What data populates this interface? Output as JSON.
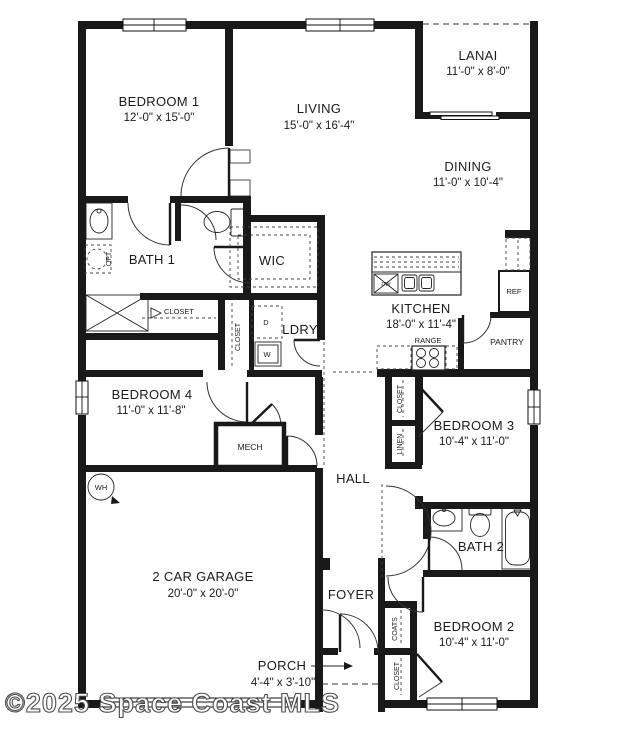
{
  "watermark": "©2025 Space Coast MLS",
  "colors": {
    "wall": "#191919",
    "background": "#ffffff",
    "watermark_outline": "#4b4b4b"
  },
  "rooms": {
    "bedroom1": {
      "name": "BEDROOM 1",
      "dims": "12'-0\" x 15'-0\""
    },
    "living": {
      "name": "LIVING",
      "dims": "15'-0\" x 16'-4\""
    },
    "lanai": {
      "name": "LANAI",
      "dims": "11'-0\" x 8'-0\""
    },
    "dining": {
      "name": "DINING",
      "dims": "11'-0\" x 10'-4\""
    },
    "kitchen": {
      "name": "KITCHEN",
      "dims": "18'-0\" x 11'-4\""
    },
    "bath1": {
      "name": "BATH 1"
    },
    "wic": {
      "name": "WIC"
    },
    "ldry": {
      "name": "LDRY"
    },
    "bedroom4": {
      "name": "BEDROOM 4",
      "dims": "11'-0\" x 11'-8\""
    },
    "bedroom3": {
      "name": "BEDROOM 3",
      "dims": "10'-4\" x 11'-0\""
    },
    "bedroom2": {
      "name": "BEDROOM 2",
      "dims": "10'-4\" x 11'-0\""
    },
    "bath2": {
      "name": "BATH 2"
    },
    "hall": {
      "name": "HALL"
    },
    "foyer": {
      "name": "FOYER"
    },
    "garage": {
      "name": "2 CAR GARAGE",
      "dims": "20'-0\" x 20'-0\""
    },
    "porch": {
      "name": "PORCH",
      "dims": "4'-4\" x 3'-10\""
    },
    "mech": {
      "name": "MECH"
    }
  },
  "fixtures": {
    "range": "RANGE",
    "pantry": "PANTRY",
    "ref": "REF",
    "dw": "DW",
    "dryer": "D",
    "washer": "W",
    "water_heater": "WH",
    "opt": "OPT",
    "closet": "CLOSET",
    "linen": "LINEN",
    "coats": "COATS"
  }
}
